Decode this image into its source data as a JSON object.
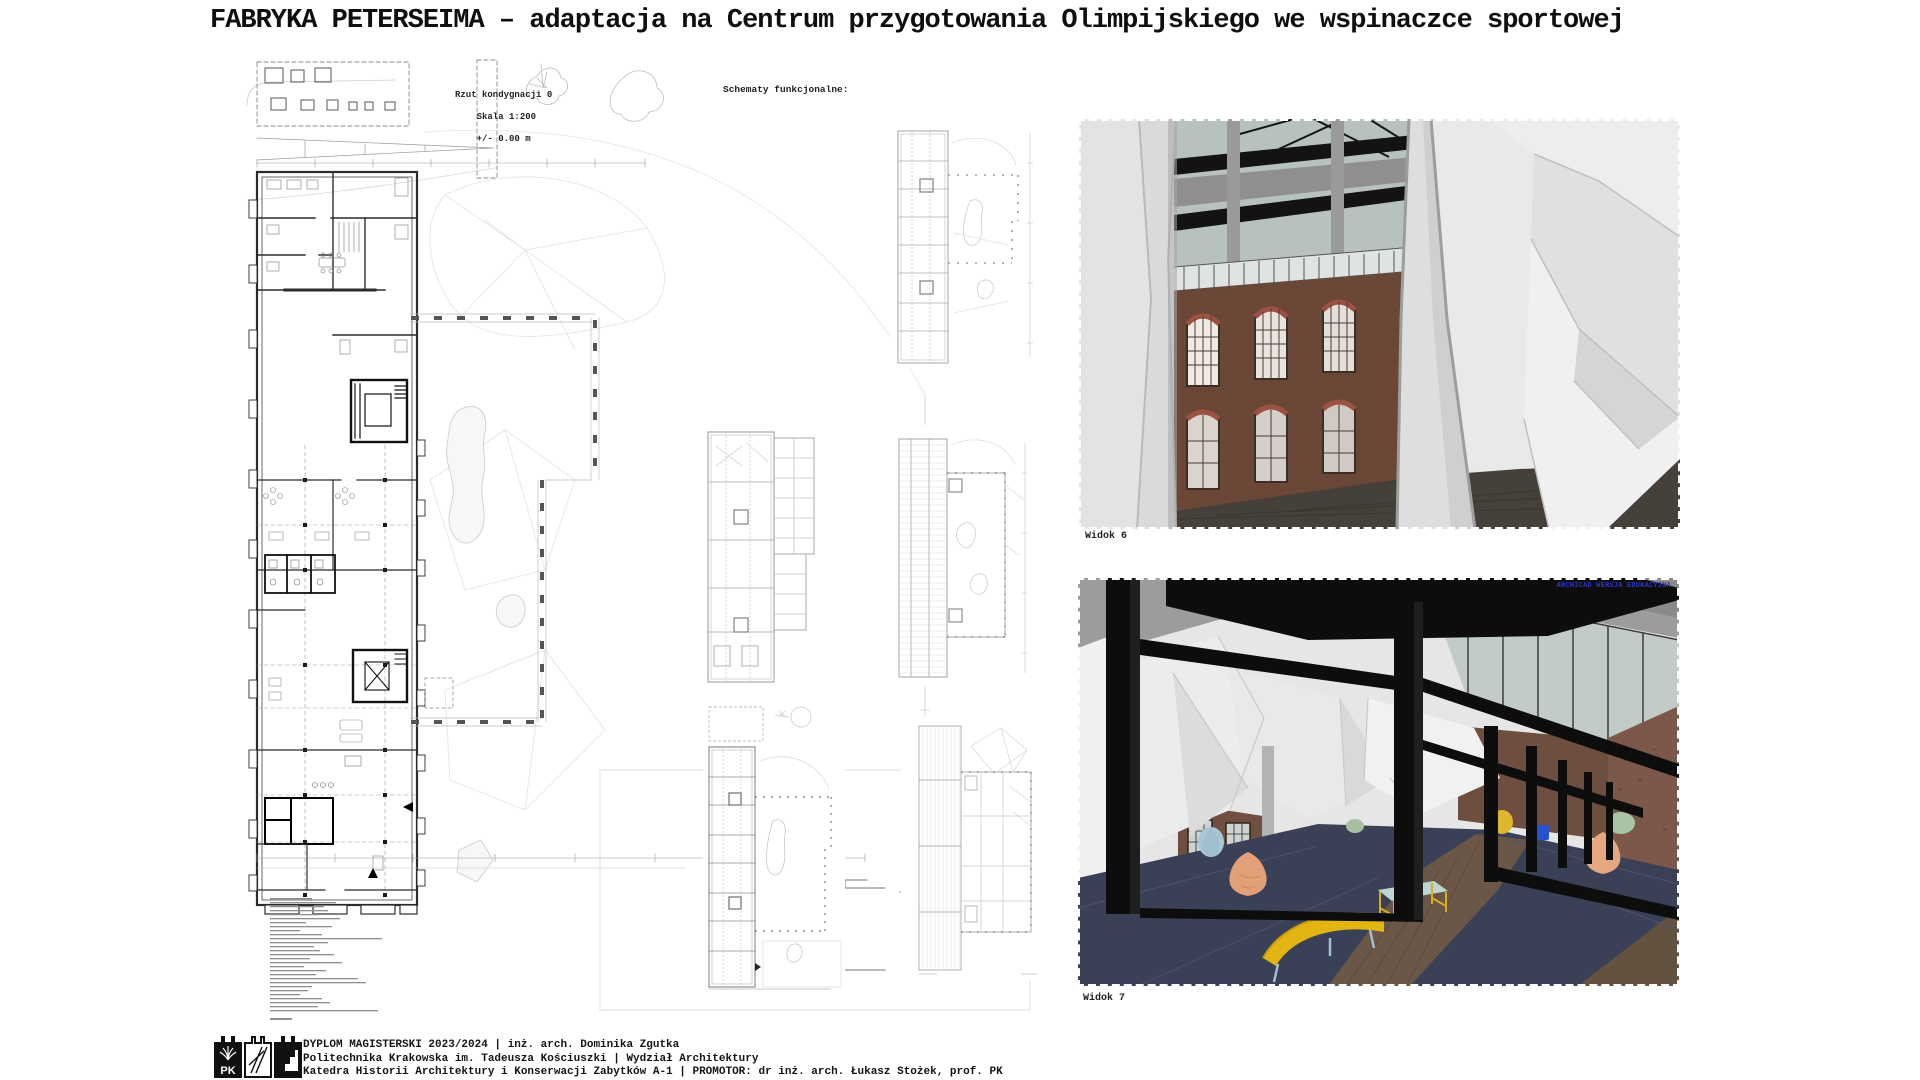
{
  "title": "FABRYKA PETERSEIMA – adaptacja na Centrum przygotowania Olimpijskiego we wspinaczce sportowej",
  "plan": {
    "title": "Rzut kondygnacji 0",
    "scale": "Skala 1:200",
    "level": "+/- 0.00 m"
  },
  "schematics": {
    "heading": "Schematy funkcjonalne:"
  },
  "views": [
    {
      "label": "Widok 6"
    },
    {
      "label": "Widok 7",
      "watermark": "ARCHICAD WERSJA EDUKACYJNA"
    }
  ],
  "footer": {
    "logo": "PK",
    "line1": "DYPLOM MAGISTERSKI 2023/2024 | inż. arch. Dominika Zgutka",
    "line2": "Politechnika Krakowska im. Tadeusza Kościuszki | Wydział Architektury",
    "line3": "Katedra Historii Architektury i Konserwacji Zabytków A-1 | PROMOTOR: dr inż. arch. Łukasz Stożek, prof. PK"
  },
  "colors": {
    "brick": "#6b4737",
    "steel_black": "#0d0d0d",
    "mat_navy": "#3a4156",
    "accent_yellow": "#e3b512",
    "watermark_blue": "#2a35c8"
  }
}
